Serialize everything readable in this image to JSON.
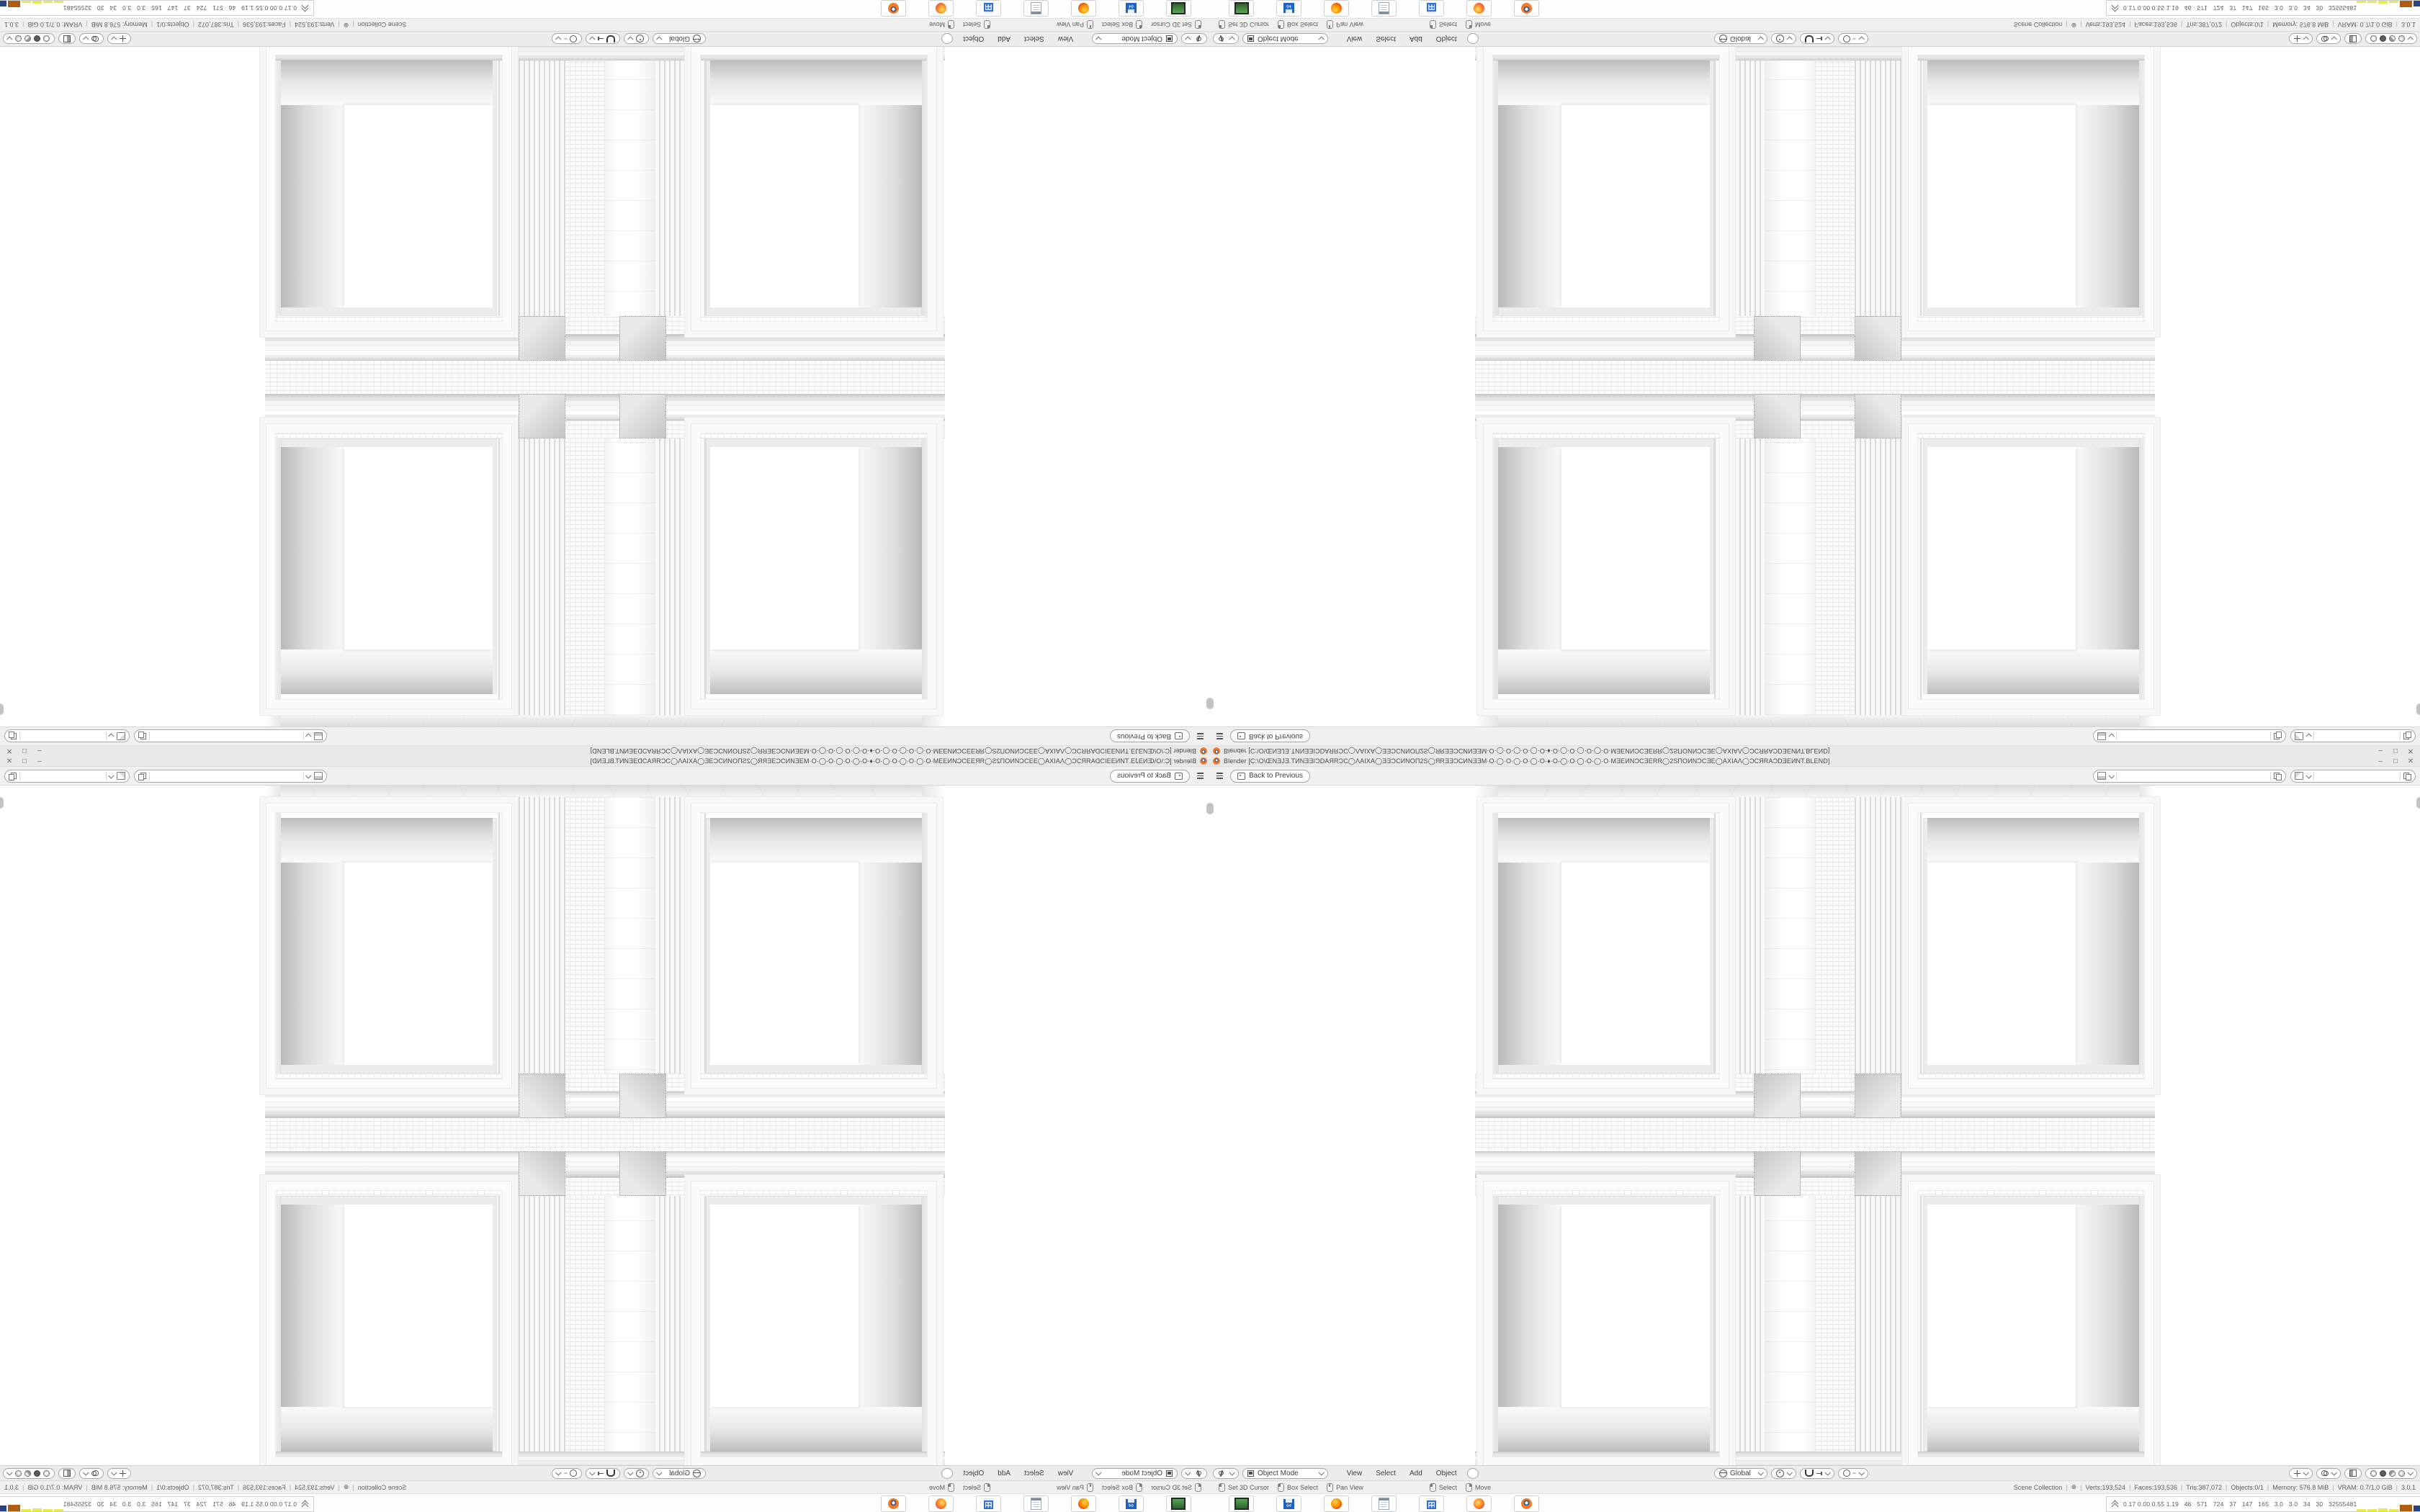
{
  "window": {
    "title": "Blender [C:\\O\\ŒNƎJƎ.TИNƎƎIƆDAЯRƆC◯ΛAIXA◯ƎƎƆCИNOΠ2S◯ЯRƎƎƆCИNƎƎM·O·◯·O·◯·O·◯·O·♦·O·◯·O·◯·O·◯·O·MƎEИNƆCƎERR◯2SΠOИNƆCƎE◯AXIAΛ◯ƆCЯRAƆDƎEИNT.BLEND]",
    "controls": {
      "minimize": "–",
      "maximize": "□",
      "close": "✕"
    },
    "topbar": {
      "back_label": "Back to Previous"
    },
    "selectors": {
      "scene_value": "",
      "viewlayer_value": ""
    },
    "viewport_header": {
      "mode": "Object Mode",
      "menus": [
        "View",
        "Select",
        "Add",
        "Object"
      ],
      "orientation": "Global"
    },
    "status_bar": {
      "sep": "|",
      "hints": [
        {
          "label": "Set 3D Cursor"
        },
        {
          "label": "Box Select"
        },
        {
          "label": "Pan View"
        }
      ],
      "hints2": [
        {
          "label": "Select"
        },
        {
          "label": "Move"
        }
      ],
      "stats": [
        "Scene Collection",
        "⊕",
        "Verts:193,524",
        "Faces:193,536",
        "Tris:387,072",
        "Objects:0/1",
        "Memory: 576.8 MiB",
        "VRAM: 0.7/1.0 GiB",
        "3.0.1"
      ]
    },
    "taskbar": {
      "apps": [
        "terminal",
        "save-64",
        "firefox",
        "notepad",
        "calculator",
        "browser",
        "blender"
      ],
      "save_label": "64",
      "perf_overlay": {
        "values": "0.17 0.00 0.55 1.19   46   571   724   37   147   165   3.0   3.0   34   30   32555481",
        "bars": [
          {
            "color": "#E9E952",
            "w": 13,
            "h": 3
          },
          {
            "color": "#E9E952",
            "w": 13,
            "h": 3
          },
          {
            "color": "#E9E952",
            "w": 13,
            "h": 4
          },
          {
            "color": "#E9E952",
            "w": 13,
            "h": 3
          },
          {
            "color": "#AE5E12",
            "w": 17,
            "h": 9
          },
          {
            "color": "#27447C",
            "w": 17,
            "h": 8
          },
          {
            "color": "#AE5E12",
            "w": 17,
            "h": 13
          },
          {
            "color": "#5BC455",
            "w": 15,
            "h": 2
          },
          {
            "color": "#5BC455",
            "w": 15,
            "h": 2
          }
        ]
      }
    }
  }
}
